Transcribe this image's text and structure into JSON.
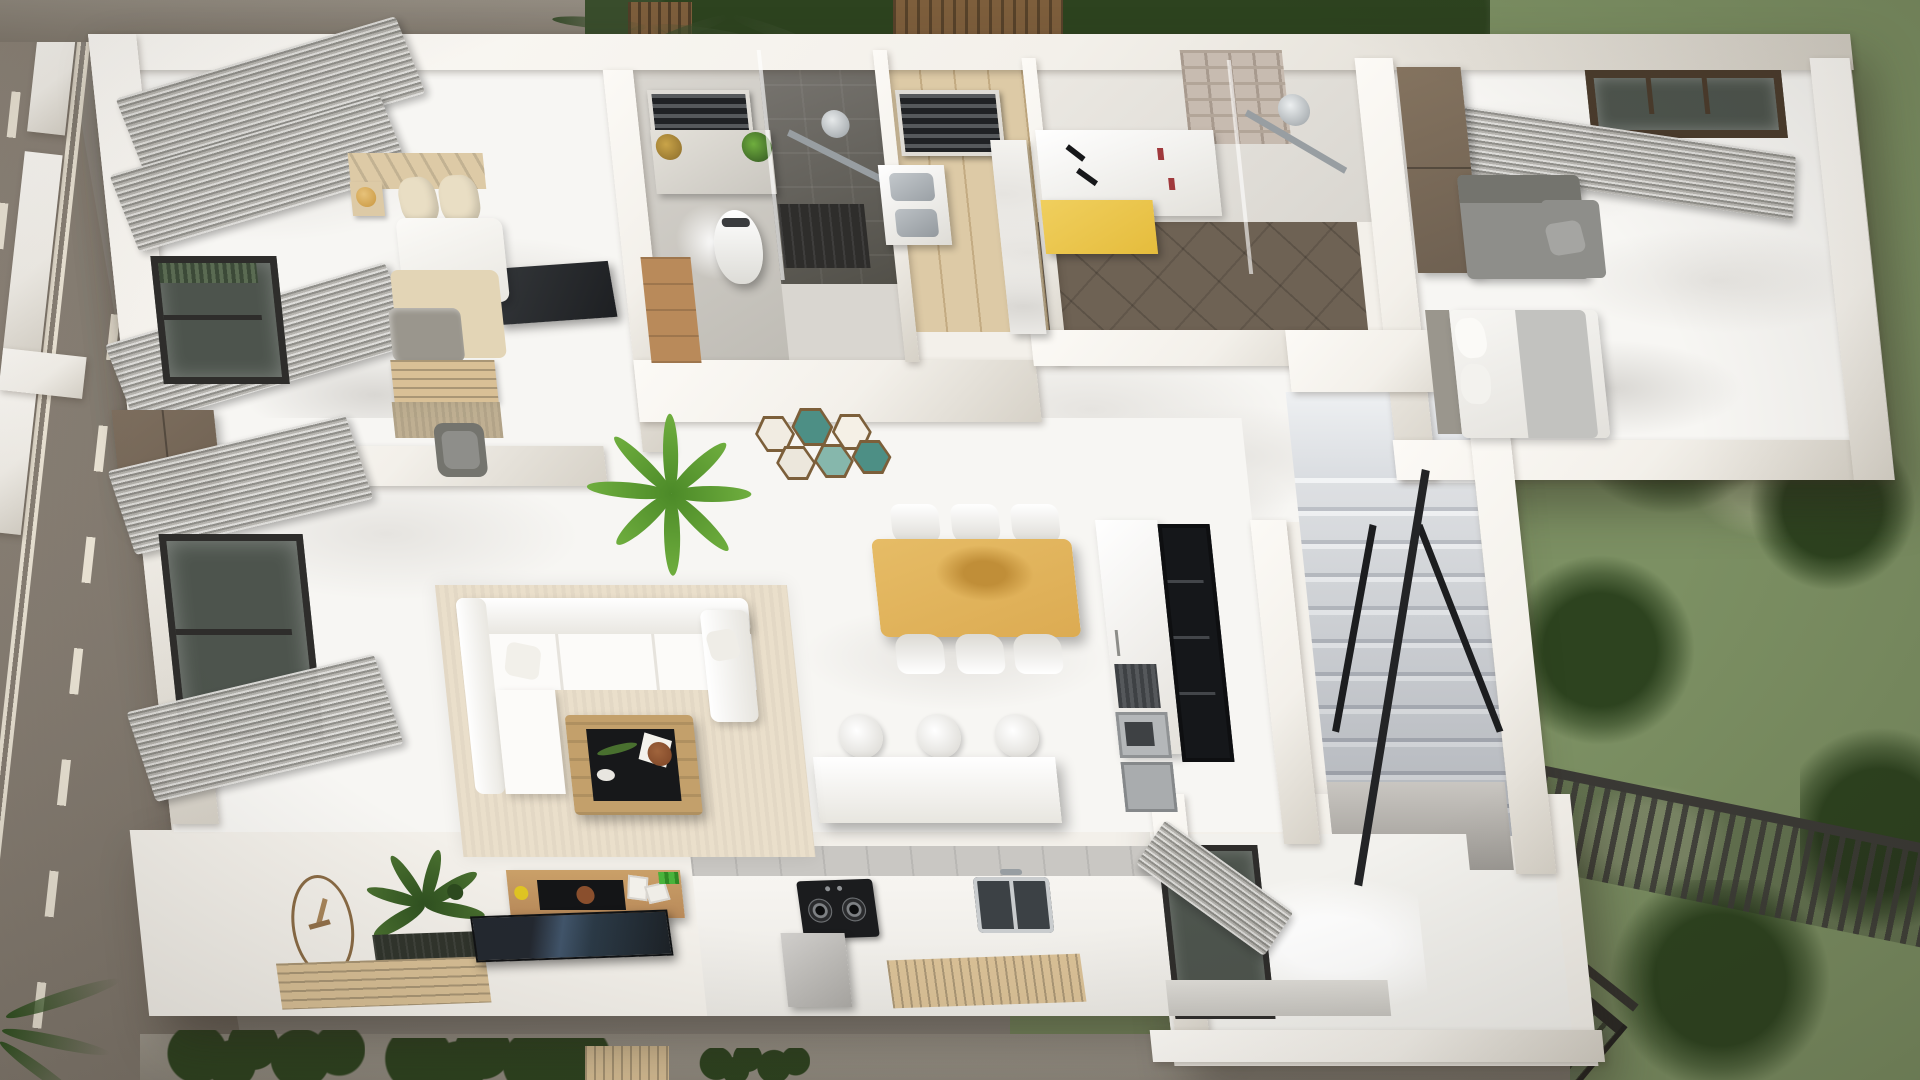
{
  "scene": {
    "type": "3d-architectural-floor-plan-render",
    "view": "top-down-birds-eye",
    "style": "photorealistic cutaway of a single-storey interior with surrounding road, lawn and garden"
  },
  "palette": {
    "ground": "#8f8980",
    "road": "#8e857a",
    "roadLo": "#766e64",
    "lane": "#ece5d6",
    "wall": "#f3f0ea",
    "wallHi": "#fcfaf6",
    "wallLo": "#d6d1c7",
    "marble": "#f7f6f3",
    "vein": "#e6e4e0",
    "vein2": "#d9d7d3",
    "concrete": "#d9d6d0",
    "concreteLo": "#bfbcb5",
    "shower": "#7a7772",
    "showerLo": "#525049",
    "woodFloor": "#ddcaa6",
    "woodLine": "#c3ab82",
    "woodMid": "#b98a5a",
    "woodDark": "#6d5b49",
    "wardrobe": "#6e6051",
    "tableWood": "#dcab52",
    "tableWoodLo": "#c08e38",
    "chair": "#f7f6f2",
    "sofa": "#fcfbf9",
    "sofaLo": "#e6e3dd",
    "graySofa": "#8e8e8a",
    "graySofaLo": "#74746e",
    "curtainHi": "#dddcd9",
    "curtainLo": "#8c8b86",
    "frame": "#2e2d2b",
    "winGlass": "#4d544d",
    "steel": "#c5c8ca",
    "steelLo": "#989ea2",
    "dark": "#202225",
    "tvGlow": "#41556b",
    "yellow": "#e5bc3c",
    "teal": "#4d8f85",
    "tealLt": "#86b7ac",
    "hexWood": "#7c5f3a",
    "rug": "#eadfcb",
    "jute": "#b9a888",
    "pillow": "#e9dec4",
    "blanket": "#e3d5b6",
    "throw": "#9a968d",
    "matDark": "#30342c",
    "woodMat": "#d9c096",
    "lawn": "#7c9063",
    "lawnLo": "#5e7647",
    "lawnHi": "#9cab80",
    "tree": "#2d431f",
    "hedge": "#394d2c",
    "planter": "#7d5e3c",
    "fence": "#3b3a36",
    "glassGreen": "#6e8060",
    "stepHi": "#eef0f2",
    "stepMid": "#d3d6da",
    "stepLo": "#abafb7",
    "entry": "#f2f1ed",
    "clockRing": "#8a6b45",
    "plantA": "#6fae3e",
    "plantALo": "#4c8a28",
    "plantB": "#49702f",
    "plantBLo": "#2f5120",
    "gold": "#c8963f",
    "brick": "#c7bbb0",
    "brickLo": "#b2a598",
    "appl": "#b4b7b9",
    "applDark": "#3e4144",
    "sink": "#3c4145",
    "counterEdge": "#c9c7c3",
    "light": "#ffffff"
  },
  "house": {
    "rooms": [
      {
        "name": "master-bedroom",
        "furniture": [
          "double-bed",
          "wood-headboard",
          "beige-pillows",
          "white-duvet",
          "beige-blanket",
          "gray-throw",
          "foot-bench",
          "jute-rug",
          "wardrobe",
          "armchair",
          "nightstand-with-pendant",
          "window",
          "gray-curtains",
          "wall-tv"
        ]
      },
      {
        "name": "bathroom-1",
        "furniture": [
          "skylight-louver",
          "vanity-with-plants",
          "wall-hung-toilet",
          "wood-cabinet",
          "walk-in-shower",
          "shower-fixture",
          "glass-screen"
        ]
      },
      {
        "name": "laundry-room",
        "furniture": [
          "skylight-louver",
          "double-basin-utility-sink",
          "marble-partition"
        ]
      },
      {
        "name": "bathroom-2",
        "furniture": [
          "double-vanity",
          "black-faucets",
          "yellow-cabinet",
          "brick-feature-wall",
          "rain-shower",
          "dark-tile-floor"
        ]
      },
      {
        "name": "bedroom-2",
        "furniture": [
          "bed",
          "gray-corner-sofa",
          "wardrobe",
          "window",
          "gray-curtains"
        ]
      },
      {
        "name": "living-room",
        "furniture": [
          "white-sectional-sofa",
          "coffee-table-with-tray",
          "area-rug",
          "flatscreen-tv",
          "media-console",
          "wall-clock",
          "floor-plant",
          "dark-doormat",
          "wood-slat-mat",
          "window",
          "gray-curtains"
        ]
      },
      {
        "name": "dining-area",
        "furniture": [
          "wooden-dining-table",
          "dining-chairs",
          "potted-palm",
          "hexagon-wall-art"
        ]
      },
      {
        "name": "kitchen",
        "furniture": [
          "island-counter",
          "bar-stools",
          "gas-cooktop",
          "range-hood",
          "double-sink",
          "wood-drain-board",
          "tall-cabinet",
          "glass-display-cabinet",
          "appliance-stack"
        ]
      },
      {
        "name": "staircase",
        "furniture": [
          "marble-steps",
          "upper-landing",
          "black-x-railing",
          "black-handrail",
          "under-stair-wall"
        ]
      },
      {
        "name": "entry-hall",
        "furniture": [
          "window-with-curtain",
          "floor-light-pool",
          "terrace-step"
        ]
      }
    ]
  },
  "exterior": {
    "features": [
      "asphalt-road",
      "dashed-lane-markings",
      "double-center-line",
      "boundary-wall",
      "top-hedge",
      "planter-boxes",
      "palm-fronds",
      "lawn",
      "garden-trees",
      "garden-fence-with-pickets",
      "glass-balustrade",
      "black-handrail",
      "concrete-walkway",
      "walkway-shrubs",
      "deck-slats"
    ]
  },
  "counts": {
    "dining_chairs": 6,
    "bar_stools": 3,
    "stair_steps": 11,
    "hexagon_panels": 6,
    "bedrooms": 2,
    "bathrooms": 2
  }
}
